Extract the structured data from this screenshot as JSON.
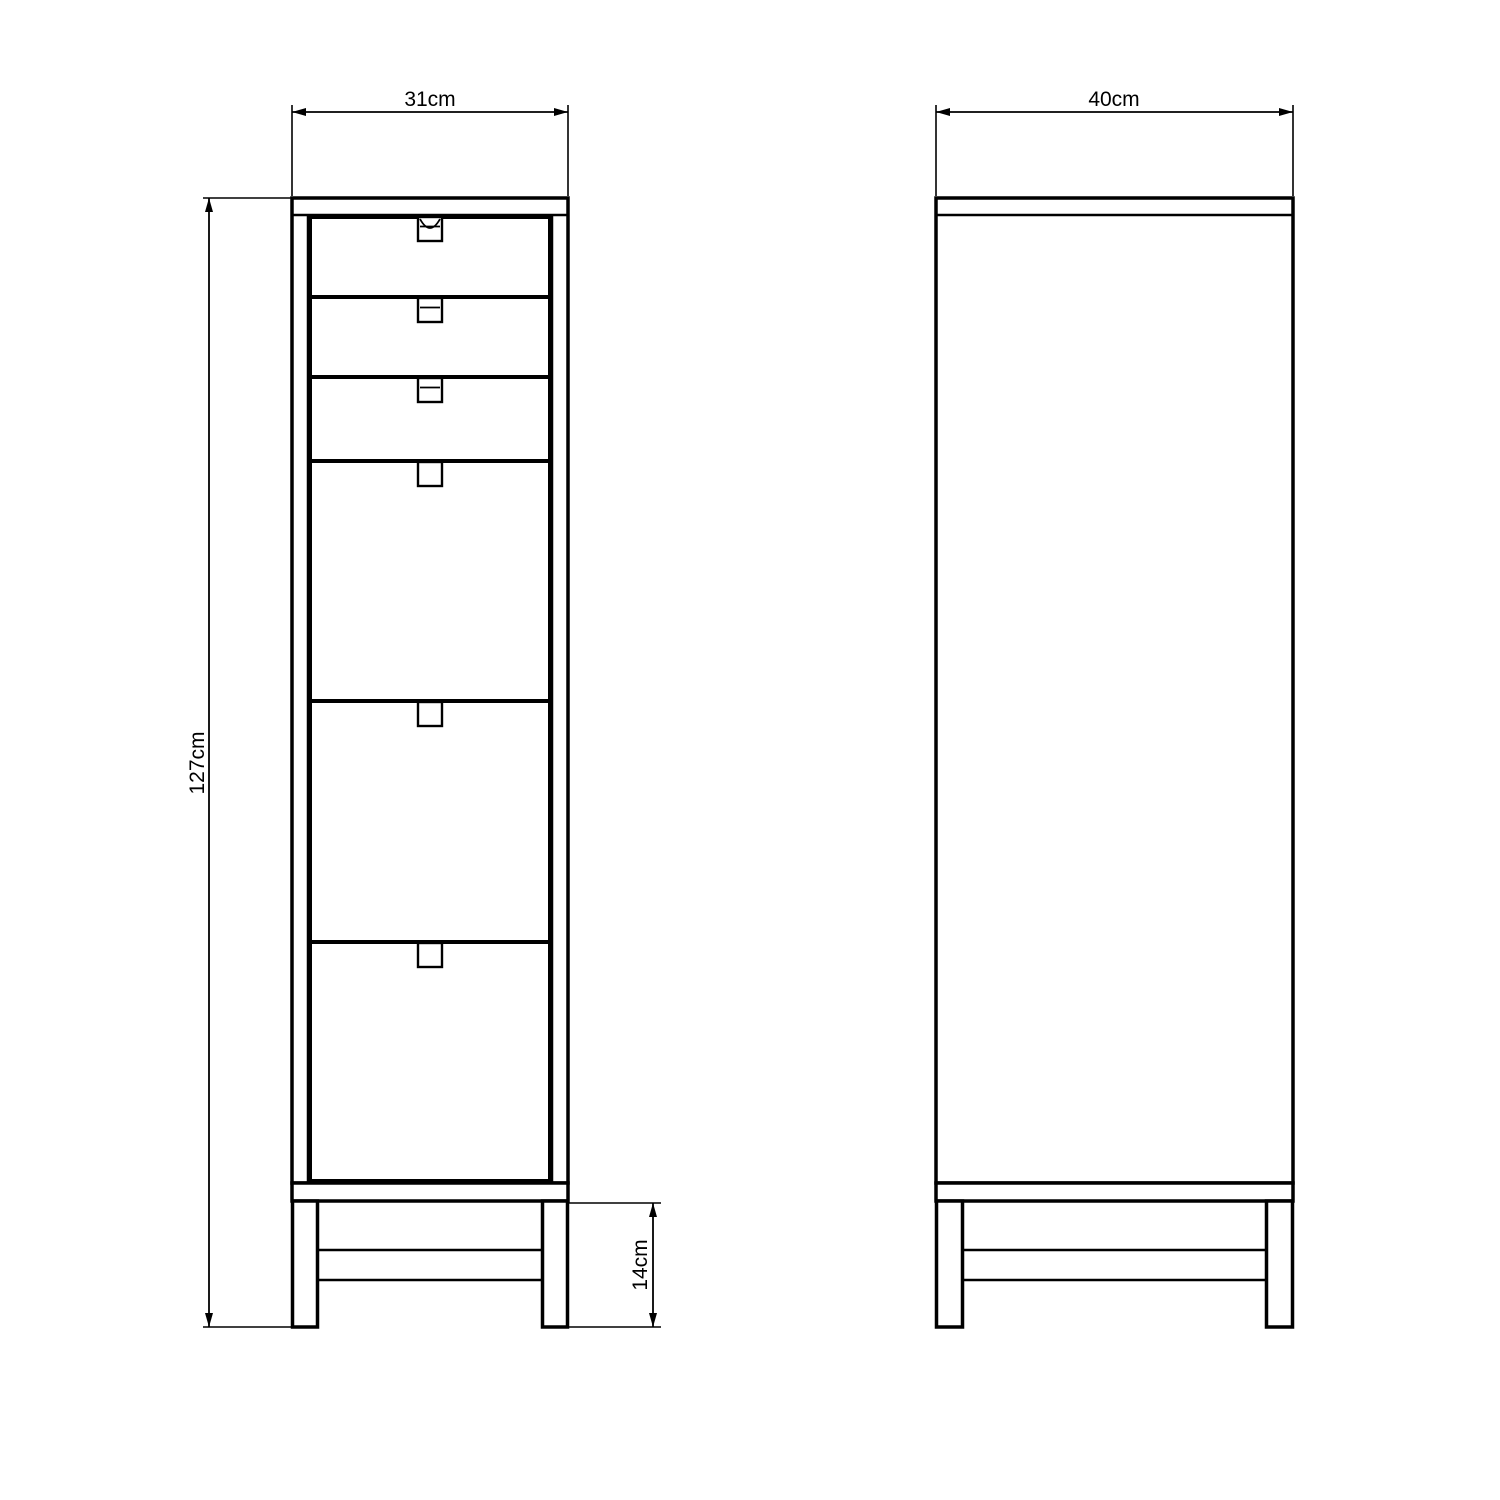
{
  "drawing": {
    "background_color": "#ffffff",
    "line_color": "#000000",
    "front_view": {
      "width_dimension": {
        "label": "31cm",
        "value_cm": 31
      },
      "height_dimension": {
        "label": "127cm",
        "value_cm": 127
      },
      "leg_height_dimension": {
        "label": "14cm",
        "value_cm": 14
      },
      "drawers": {
        "small_count": 3,
        "large_count": 3,
        "total": 6
      }
    },
    "side_view": {
      "depth_dimension": {
        "label": "40cm",
        "value_cm": 40
      }
    }
  }
}
